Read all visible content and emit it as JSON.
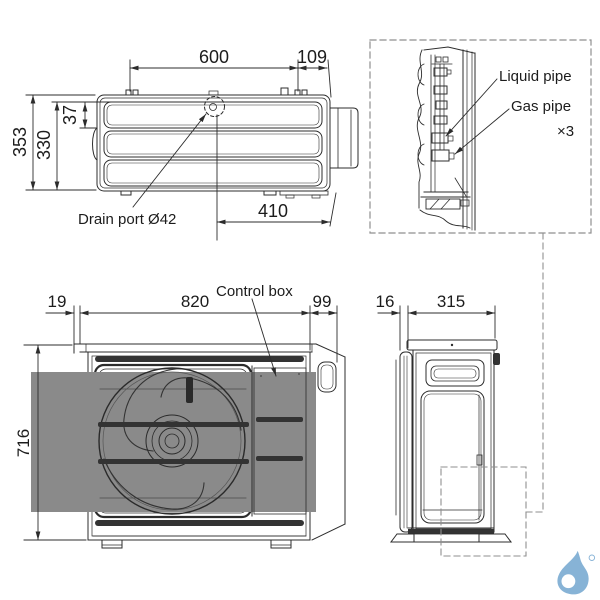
{
  "top_view": {
    "dim_width_top": "600",
    "dim_width_right": "109",
    "dim_height_overall": "353",
    "dim_height_body": "330",
    "dim_drain_offset": "37",
    "dim_bottom": "410",
    "drain_label": "Drain port Ø42"
  },
  "pipe_detail": {
    "liquid_pipe_label": "Liquid pipe",
    "gas_pipe_label": "Gas pipe",
    "multiplier": "×3"
  },
  "front_view": {
    "dim_left": "19",
    "dim_width": "820",
    "dim_right": "99",
    "dim_height": "716",
    "control_box_label": "Control box"
  },
  "side_view": {
    "dim_back": "16",
    "dim_depth": "315"
  },
  "colors": {
    "line": "#2c2c2c",
    "logo_blue": "#87b3d6"
  }
}
